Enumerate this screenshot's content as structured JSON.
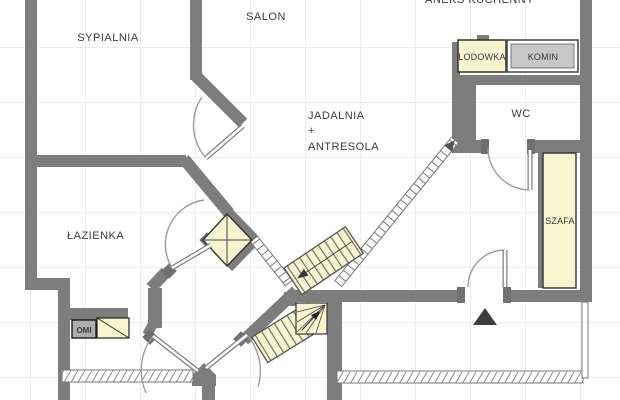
{
  "labels": {
    "sypialnia": "SYPIALNIA",
    "salon": "SALON",
    "aneks_kuchenny": "ANEKS KUCHENNY",
    "jadalnia_line1": "JADALNIA",
    "jadalnia_line2": "+",
    "jadalnia_line3": "ANTRESOLA",
    "wc": "WC",
    "lazienka": "ŁAZIENKA",
    "lodowka": "LODOWKA",
    "komin": "KOMIN",
    "szafa": "SZAFA",
    "komin_small": "OMI"
  },
  "colors": {
    "wall": "#7d7d7d",
    "jamb": "#6f6f6f",
    "fixture_yellow": "#f7f4cf",
    "komin_gray": "#c7c7c7",
    "small_chimney_gray": "#adadad",
    "grid_line": "#ececec",
    "arrow_dark": "#3d3d3d",
    "door_arc": "#9b9b9b",
    "text": "#3a3a3a"
  }
}
